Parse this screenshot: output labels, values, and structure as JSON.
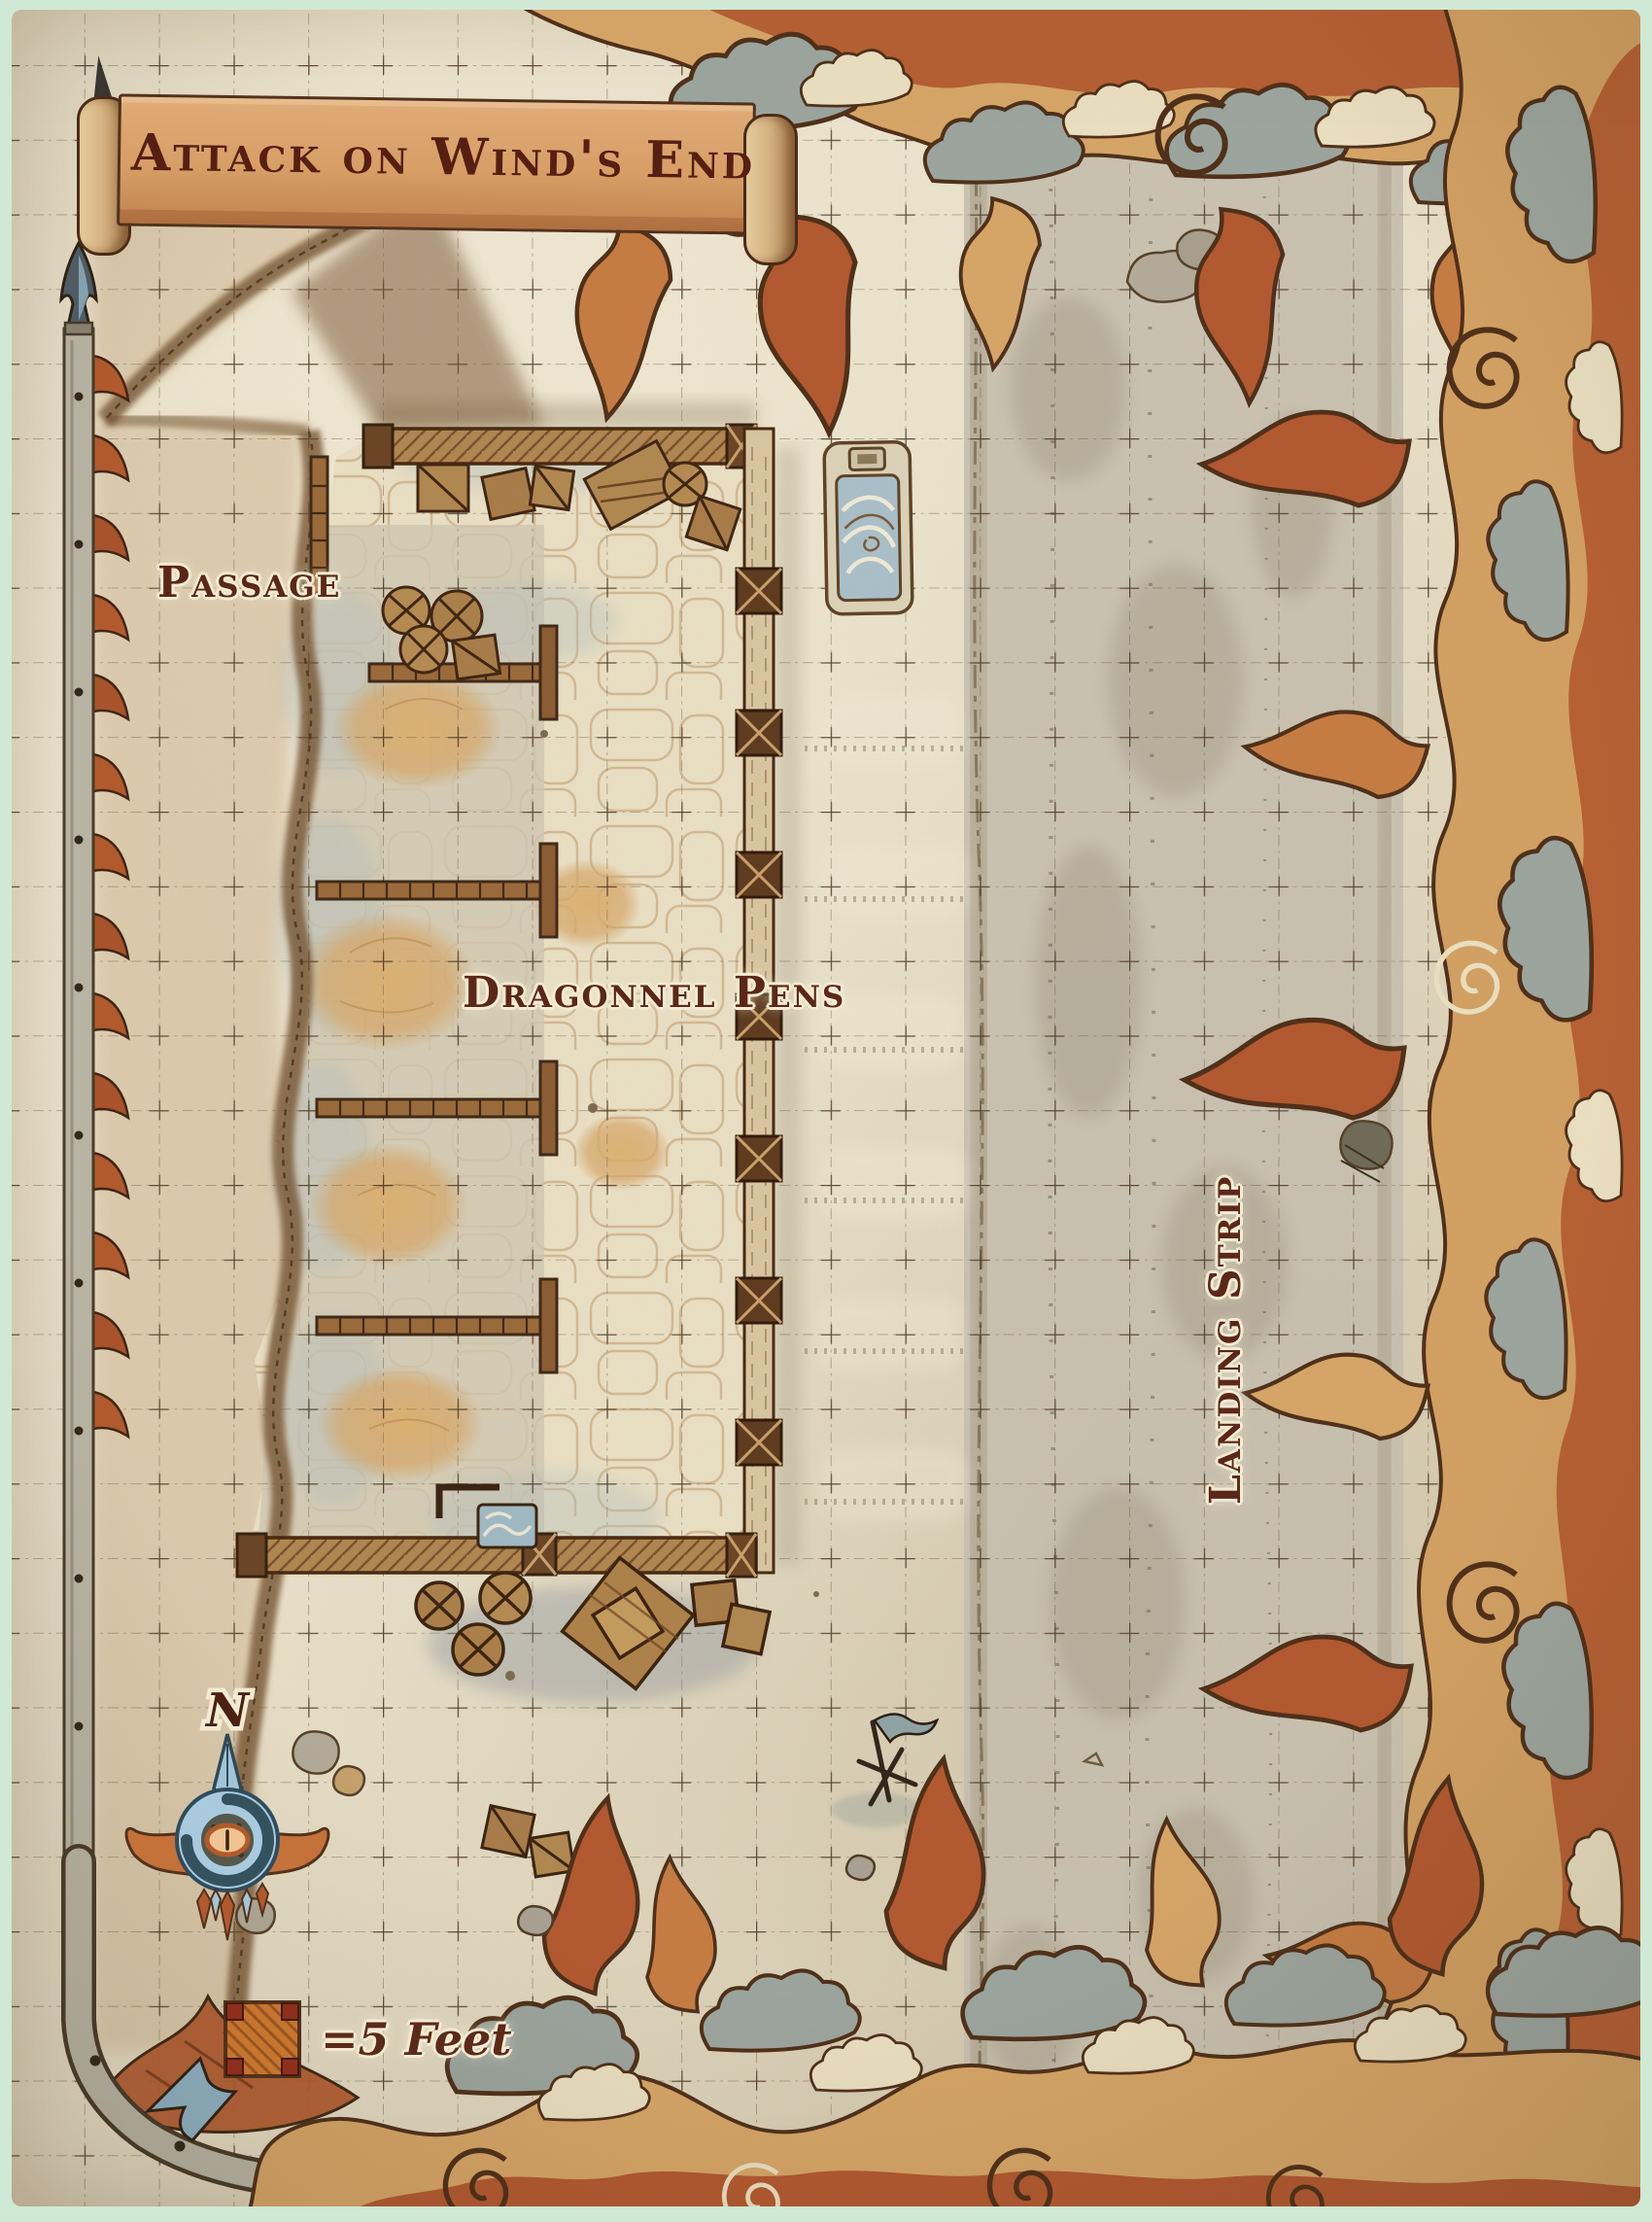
{
  "map": {
    "title": "Attack on Wind's End",
    "labels": {
      "passage": "Passage",
      "dragonnel_pens": "Dragonnel Pens",
      "landing_strip": "Landing Strip"
    },
    "compass": {
      "north": "N"
    },
    "legend": {
      "scale_text": "=5 Feet"
    },
    "colors": {
      "page_edge_green": "#cfe9d5",
      "parchment": "#e8dfc8",
      "ink_text": "#5b2718",
      "text_halo": "#f3ead2",
      "flame_rust": "#b2582f",
      "flame_orange": "#c57c42",
      "flame_tan": "#d6a567",
      "smoke_gray": "#9ba59e",
      "smoke_cream": "#eadfc0",
      "compass_blue": "#a3c4d8",
      "scale_square_orange": "#c6752f",
      "landing_strip_gray": "#c6bfae",
      "wood_wall": "#b08550"
    }
  }
}
